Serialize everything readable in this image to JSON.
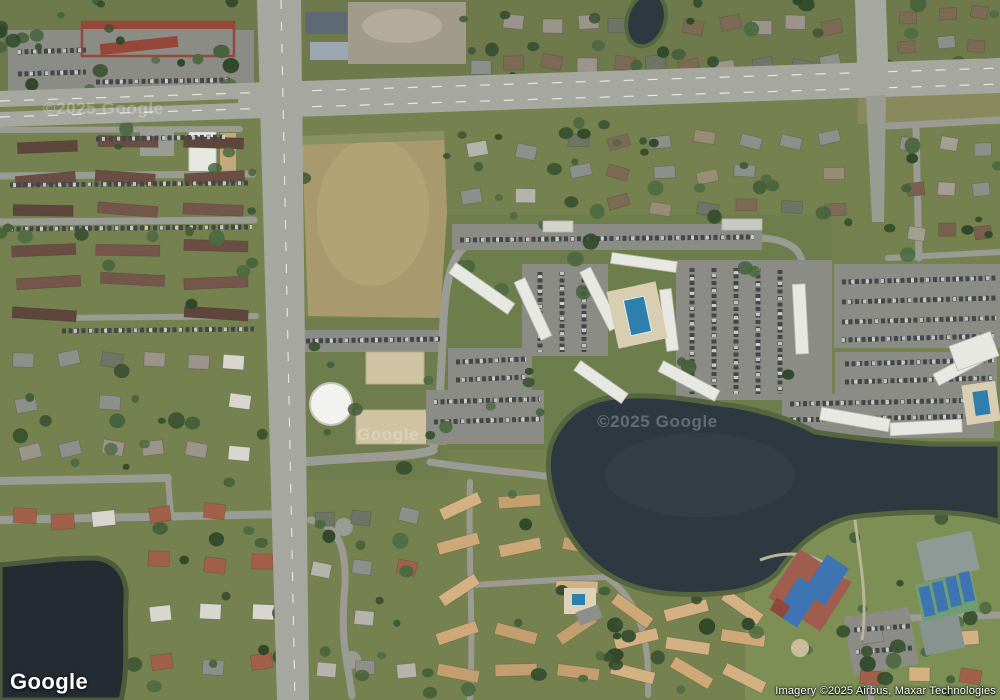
{
  "map": {
    "provider": "Google",
    "view_type": "satellite-imagery",
    "logo": "Google",
    "attribution": "Imagery ©2025 Airbus, Maxar Technologies",
    "watermarks": {
      "left": "©2025 Google",
      "center": "©2025 Google",
      "small": "Google"
    },
    "colors": {
      "grass": "#75814f",
      "grass_dark": "#6e7a4b",
      "grass_complex": "#6d7d4c",
      "grass_park": "#7e8f55",
      "water": "#2e3841",
      "water_dark": "#242b33",
      "shore_green": "#55653f",
      "road_major": "#a6a79f",
      "road_minor": "#9a9b93",
      "field_tan": "#a89a6c",
      "field_tan_light": "#b2a375",
      "dirt": "#a19b8b",
      "building_white": "#e8e8e2",
      "building_gray": "#8b8c86",
      "roof_commercial_red": "#96473a",
      "roof_maroon": "#6a4e43",
      "roof_red_tile": "#a2604a",
      "roof_tan": "#d4b183",
      "roof_gray": "#8d8f8a",
      "parking": "#8a8c85",
      "car_dark": "#43474c",
      "car_light": "#d8d8d4",
      "pool_blue": "#2f7fae",
      "pool_deck": "#d9ceb2",
      "court_blue": "#3e74b2",
      "court_green": "#6f9d74",
      "court_gray": "#8e9a96",
      "court_surround_red": "#a05c4c",
      "sand_pad": "#cfc3a4",
      "tree_dark": "#3a5232"
    }
  }
}
